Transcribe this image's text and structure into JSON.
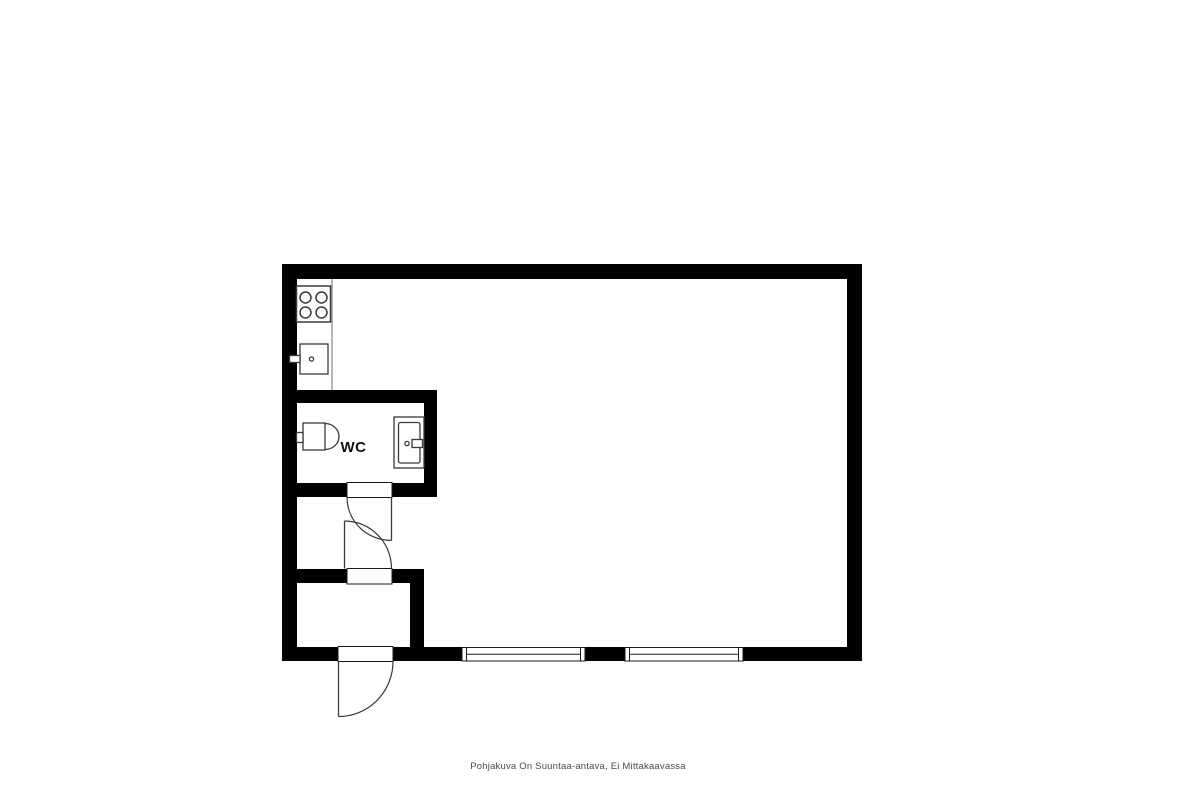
{
  "image": {
    "type": "floor-plan"
  },
  "labels": {
    "wc": "WC"
  },
  "caption": {
    "text": "Pohjakuva On Suuntaa-antava, Ei Mittakaavassa"
  },
  "colors": {
    "background": "#ffffff",
    "wall": "#000000",
    "fixture-line": "#3a3a3a",
    "opening-line": "#1a1a1a",
    "counter-line": "#6e6e6e",
    "caption-text": "#4a4a4a",
    "label-text": "#111111"
  },
  "fixtures": {
    "stove": "stove-icon",
    "kitchen_sink": "kitchen-sink-icon",
    "toilet": "toilet-icon",
    "wc_sink": "wc-sink-icon"
  },
  "openings": {
    "doors": [
      "wc-door",
      "vestibule-door",
      "entrance-door"
    ],
    "windows": [
      "window-1",
      "window-2"
    ]
  }
}
